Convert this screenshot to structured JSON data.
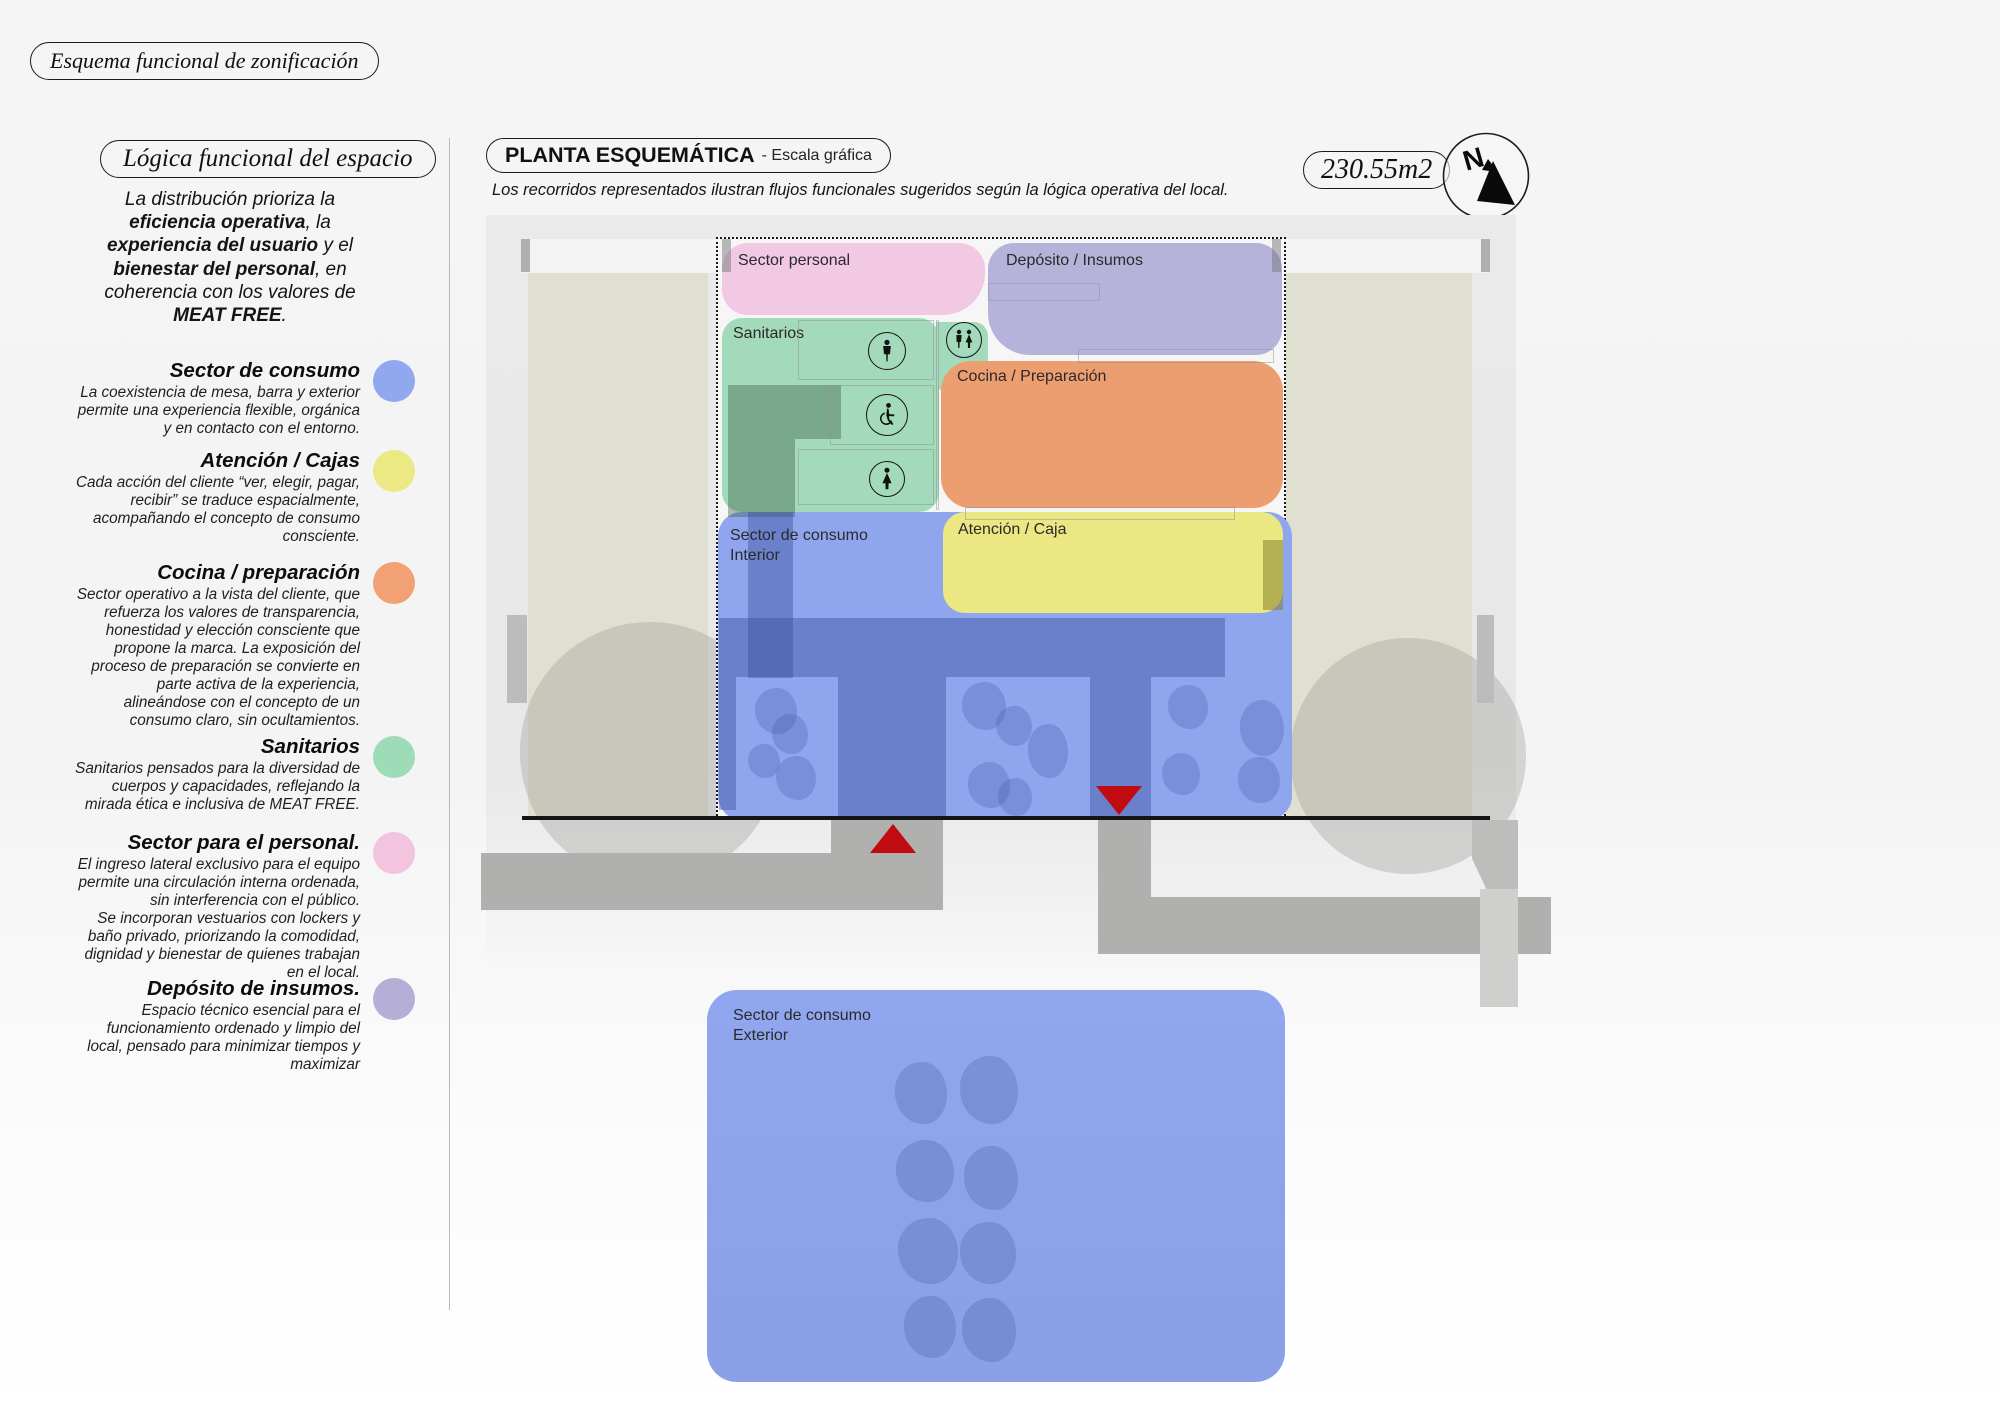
{
  "header": {
    "tag": "Esquema funcional de zonificación"
  },
  "sidebar": {
    "title": "Lógica funcional del espacio",
    "intro": {
      "l1": "La distribución prioriza la",
      "l2b": "eficiencia operativa",
      "l2": ", la",
      "l3b": "experiencia del usuario",
      "l3": " y el",
      "l4b": "bienestar del personal",
      "l4": ", en",
      "l5": "coherencia con los valores de",
      "l6b": "MEAT FREE",
      "l6": "."
    },
    "legend": [
      {
        "title": "Sector de consumo",
        "color": "#91a8ef",
        "desc": "La coexistencia de mesa, barra y exterior permite una experiencia flexible, orgánica y en contacto con el entorno."
      },
      {
        "title": "Atención / Cajas",
        "color": "#ece883",
        "desc": "Cada acción del cliente “ver, elegir, pagar, recibir” se traduce espacialmente, acompañando el concepto de consumo consciente."
      },
      {
        "title": "Cocina / preparación",
        "color": "#f1a173",
        "desc": "Sector operativo a la vista del cliente, que refuerza los valores de transparencia, honestidad y elección consciente que propone la marca. La exposición del proceso de preparación se convierte en parte activa de la experiencia, alineándose con el concepto de un consumo claro, sin ocultamientos."
      },
      {
        "title": "Sanitarios",
        "color": "#9edcb8",
        "desc": "Sanitarios pensados para la diversidad de cuerpos y capacidades, reflejando la mirada ética e inclusiva de MEAT FREE."
      },
      {
        "title": "Sector para el personal.",
        "color": "#f2c4de",
        "desc": "El ingreso lateral exclusivo para el equipo permite una circulación interna ordenada, sin interferencia con el público.\nSe incorporan vestuarios con lockers y baño privado, priorizando la comodidad, dignidad y bienestar de quienes trabajan en el local."
      },
      {
        "title": "Depósito de insumos.",
        "color": "#b5afd7",
        "desc": "Espacio técnico esencial para el funcionamiento ordenado y limpio del local, pensado para minimizar tiempos y maximizar"
      }
    ]
  },
  "plan": {
    "badge": "PLANTA ESQUEMÁTICA",
    "badge_suffix": "- Escala gráfica",
    "note": "Los recorridos representados ilustran flujos funcionales sugeridos según la lógica operativa del local.",
    "area": "230.55m2",
    "labels": {
      "personal": "Sector personal",
      "deposito": "Depósito / Insumos",
      "sanitarios": "Sanitarios",
      "cocina": "Cocina / Preparación",
      "atencion": "Atención / Caja",
      "consumo_interior": "Sector de consumo\nInterior",
      "consumo_exterior": "Sector de consumo\nExterior"
    },
    "colors": {
      "pink": "#f1c9e3",
      "purple": "#b6b3db",
      "green": "#a3dabc",
      "orange": "#ec9e70",
      "yellow": "#ebe783",
      "blue": "#8fa6ef",
      "blue_exterior": "#8ca2ec",
      "red": "#c00b10",
      "beige": "#e0e0d1"
    }
  }
}
